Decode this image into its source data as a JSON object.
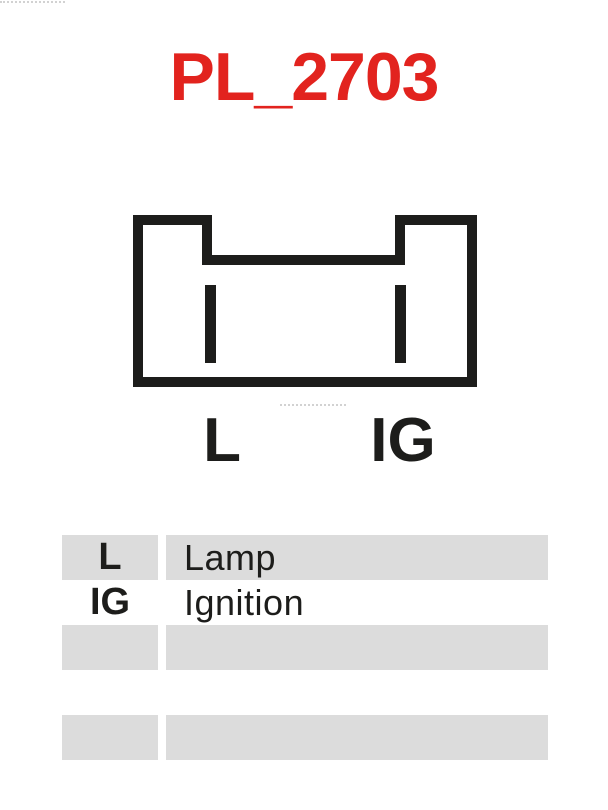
{
  "page": {
    "title": "PL_2703"
  },
  "connector_diagram": {
    "pin_labels": [
      "L",
      "IG"
    ]
  },
  "legend_table": {
    "rows": [
      {
        "pin": "L",
        "description": "Lamp"
      },
      {
        "pin": "IG",
        "description": "Ignition"
      },
      {
        "pin": "",
        "description": ""
      },
      {
        "pin": "",
        "description": ""
      },
      {
        "pin": "",
        "description": ""
      }
    ]
  },
  "colors": {
    "title_red": "#e2231e",
    "line_black": "#1d1d1b",
    "row_stripe_gray": "#dcdcdc"
  }
}
